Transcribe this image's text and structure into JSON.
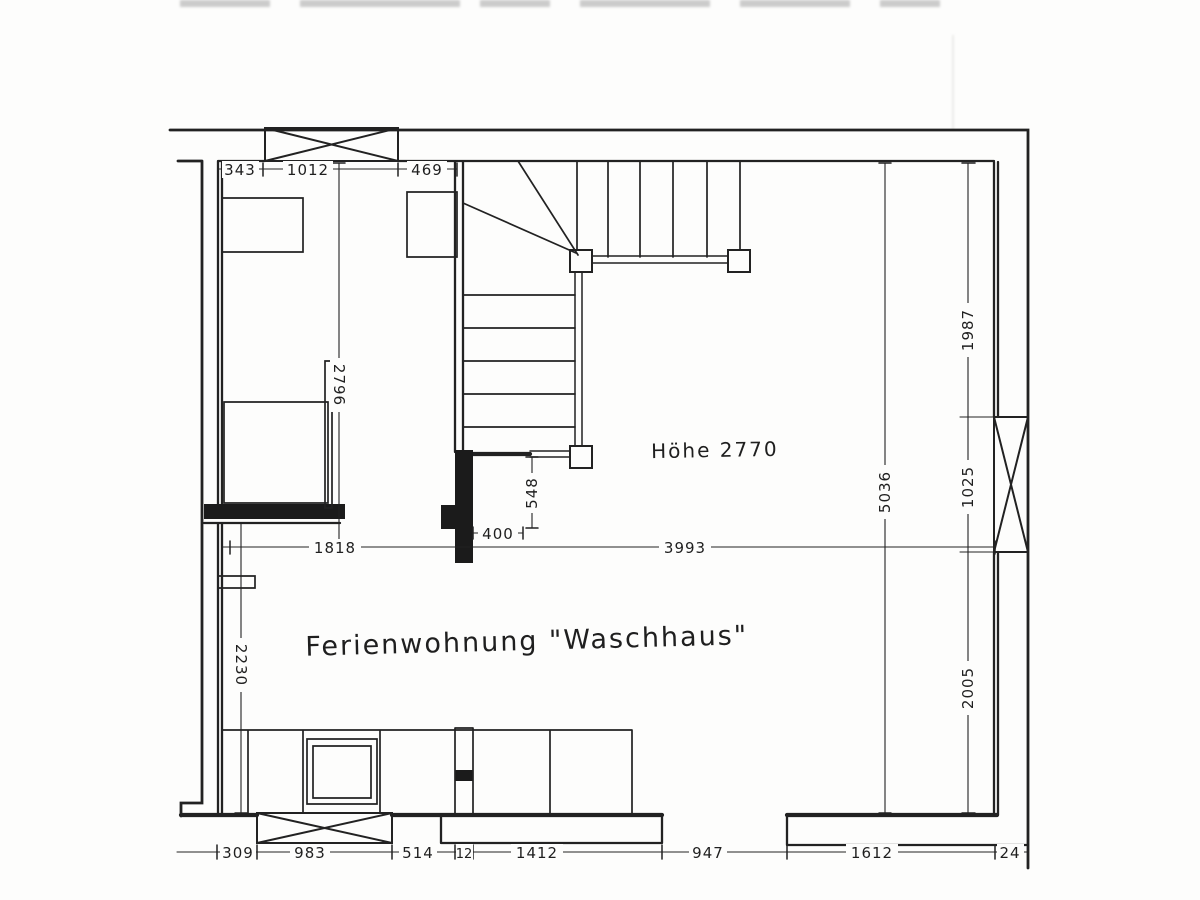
{
  "annotations": {
    "room_label": "Ferienwohnung \"Waschhaus\"",
    "height_note": "Höhe 2770"
  },
  "dims": {
    "d343": "343",
    "d1012": "1012",
    "d469": "469",
    "d2796": "2796",
    "d2230": "2230",
    "d1818": "1818",
    "d3993": "3993",
    "d400": "400",
    "d548": "548",
    "d1987": "1987",
    "d5036": "5036",
    "d1025": "1025",
    "d2005": "2005",
    "d309": "309",
    "d983": "983",
    "d514": "514",
    "d12": "12",
    "d1412": "1412",
    "d947": "947",
    "d1612": "1612",
    "d24": "24"
  },
  "colors": {
    "ink": "#222222",
    "paper": "#fdfdfc"
  }
}
